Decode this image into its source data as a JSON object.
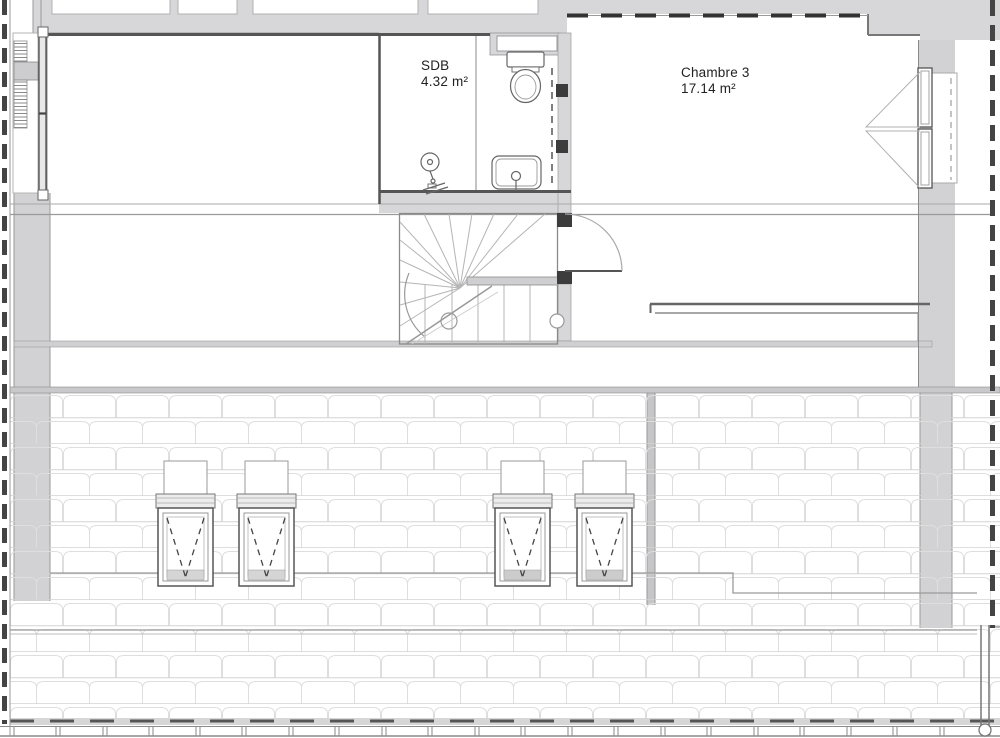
{
  "plan": {
    "title": "Attic floor plan",
    "rooms": [
      {
        "id": "sdb",
        "name": "SDB",
        "area": "4.32 m²"
      },
      {
        "id": "chambre3",
        "name": "Chambre 3",
        "area": "17.14 m²"
      }
    ],
    "fixtures": [
      "toilet",
      "washbasin",
      "shower-fixture",
      "staircase",
      "stair-door",
      "left-facade-window",
      "right-facade-window",
      "roof-window-1",
      "roof-window-2",
      "roof-window-3",
      "roof-window-4",
      "gutter-downpipe"
    ],
    "colors": {
      "background": "#ffffff",
      "wall_fill": "#d7d7d9",
      "wall_line": "#5a5a5a",
      "detail_line": "#9a9a9a",
      "tile_line": "#dedede",
      "jamb_fill": "#3c3c3c",
      "boundary_dash": "#444444"
    }
  }
}
